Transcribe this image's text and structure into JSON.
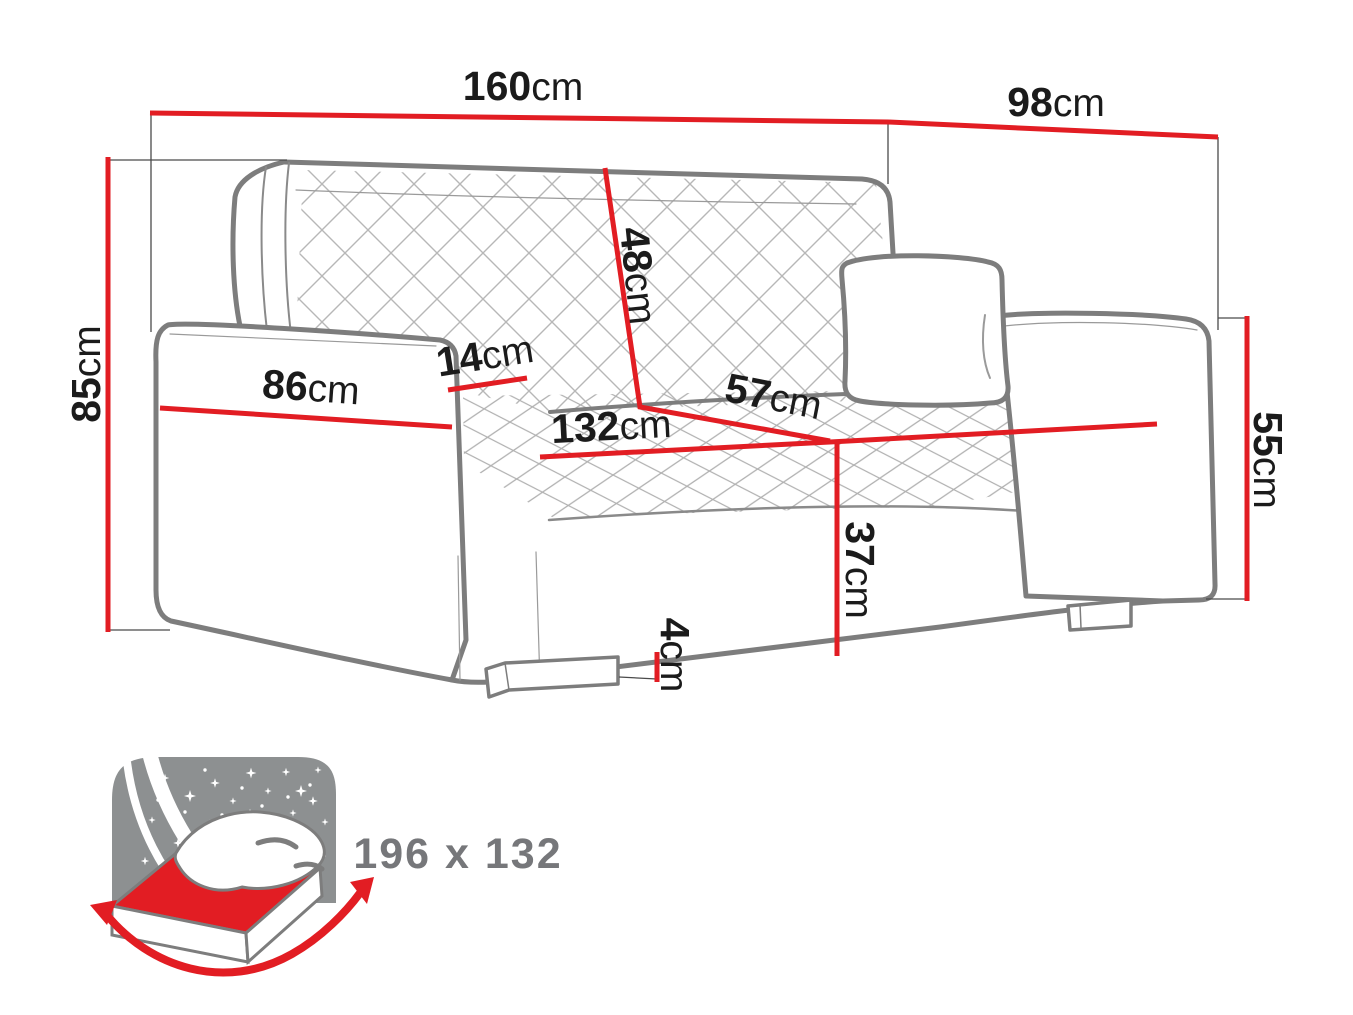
{
  "dimensions": {
    "overall_width": {
      "value": "160",
      "unit": "cm"
    },
    "overall_depth": {
      "value": "98",
      "unit": "cm"
    },
    "overall_height": {
      "value": "85",
      "unit": "cm"
    },
    "backrest_height": {
      "value": "48",
      "unit": "cm"
    },
    "armrest_width": {
      "value": "14",
      "unit": "cm"
    },
    "armrest_length": {
      "value": "86",
      "unit": "cm"
    },
    "seat_depth": {
      "value": "57",
      "unit": "cm"
    },
    "seat_width": {
      "value": "132",
      "unit": "cm"
    },
    "side_height": {
      "value": "55",
      "unit": "cm"
    },
    "seat_height": {
      "value": "37",
      "unit": "cm"
    },
    "leg_height": {
      "value": "4",
      "unit": "cm"
    }
  },
  "sleeping_area": {
    "size_label": "196 x 132"
  },
  "colors": {
    "dimension_red": "#e21d23",
    "outline_gray": "#7d7d7d",
    "quilt_gray": "#b7b7b7",
    "icon_sky_gray": "#8d9091",
    "label_black": "#1b1b1b",
    "size_text_gray": "#76777a"
  }
}
